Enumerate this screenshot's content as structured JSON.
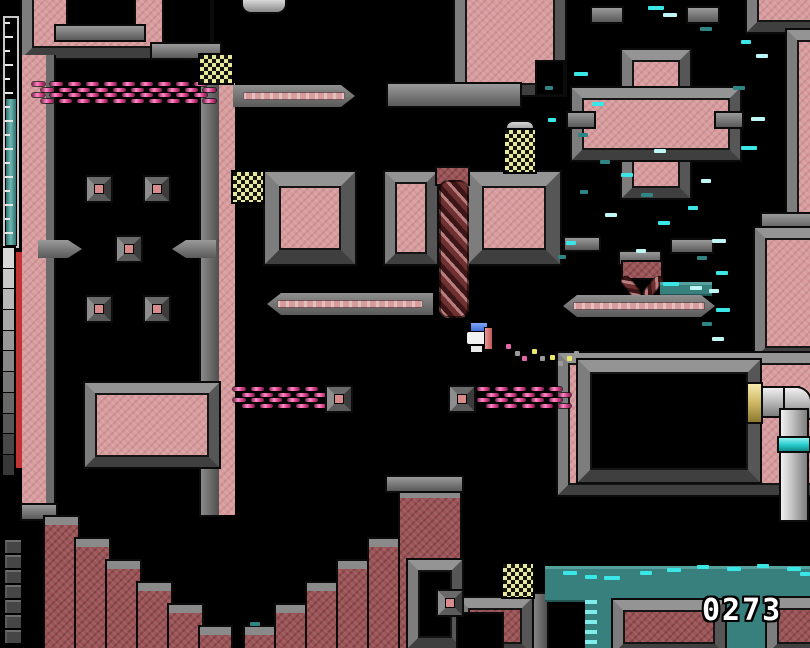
{
  "hud": {
    "score": "0273",
    "energy_gauge": {
      "ticks": 16,
      "fill_pct": 62
    },
    "gray_meter_segments": 11,
    "brick_stack_count": 7
  },
  "palette": {
    "wall_pink": "#d79c9e",
    "wall_maroon": "#9b5356",
    "frame_gray": "#6b6b6b",
    "background": "#000000",
    "drip_cyan_bright": "#3ae6e6",
    "drip_cyan_pale": "#bdf6f4",
    "drip_teal_dim": "#2f8583",
    "water_teal": "#37807e",
    "chain_magenta": "#e0458f",
    "checker_yellow": "#e6e69c",
    "gauge_teal": "#4d9b97",
    "meter_red": "#c23434",
    "pipe_gold": "#d9c56e",
    "player_blue": "#4a7ce0",
    "player_white": "#f2f2f2",
    "player_pink": "#d97c7c"
  },
  "scene": {
    "weaves": [
      {
        "x": 32,
        "y": 82,
        "cols": 10,
        "rows": 4
      },
      {
        "x": 233,
        "y": 387,
        "cols": 5,
        "rows": 4
      },
      {
        "x": 477,
        "y": 387,
        "cols": 5,
        "rows": 4
      }
    ],
    "diamonds": [
      [
        85,
        175
      ],
      [
        143,
        175
      ],
      [
        115,
        235
      ],
      [
        85,
        295
      ],
      [
        143,
        295
      ],
      [
        325,
        385
      ],
      [
        448,
        385
      ],
      [
        436,
        589
      ]
    ],
    "checkers": [
      [
        200,
        55,
        32,
        28
      ],
      [
        233,
        172,
        30,
        30
      ],
      [
        505,
        130,
        30,
        42
      ],
      [
        503,
        564,
        30,
        33
      ]
    ],
    "drips": [
      [
        648,
        6,
        16,
        0
      ],
      [
        663,
        13,
        14,
        1
      ],
      [
        700,
        27,
        12,
        2
      ],
      [
        741,
        40,
        10,
        0
      ],
      [
        756,
        54,
        12,
        1
      ],
      [
        574,
        72,
        14,
        0
      ],
      [
        733,
        86,
        12,
        2
      ],
      [
        592,
        102,
        12,
        0
      ],
      [
        751,
        117,
        14,
        1
      ],
      [
        578,
        133,
        10,
        2
      ],
      [
        741,
        146,
        16,
        0
      ],
      [
        654,
        149,
        12,
        1
      ],
      [
        600,
        160,
        10,
        2
      ],
      [
        621,
        173,
        12,
        0
      ],
      [
        701,
        179,
        10,
        1
      ],
      [
        641,
        193,
        12,
        2
      ],
      [
        688,
        206,
        10,
        0
      ],
      [
        605,
        213,
        12,
        1
      ],
      [
        580,
        190,
        8,
        2
      ],
      [
        658,
        221,
        12,
        0
      ],
      [
        712,
        239,
        14,
        1
      ],
      [
        697,
        256,
        10,
        2
      ],
      [
        716,
        271,
        12,
        0
      ],
      [
        709,
        289,
        10,
        1
      ],
      [
        716,
        308,
        14,
        0
      ],
      [
        702,
        322,
        10,
        2
      ],
      [
        712,
        337,
        12,
        1
      ],
      [
        566,
        241,
        10,
        0
      ],
      [
        558,
        255,
        8,
        2
      ],
      [
        636,
        249,
        10,
        1
      ],
      [
        545,
        86,
        8,
        2
      ],
      [
        548,
        118,
        8,
        0
      ],
      [
        250,
        622,
        10,
        2
      ],
      [
        663,
        282,
        16,
        0
      ],
      [
        690,
        286,
        12,
        1
      ]
    ],
    "sparkles": [
      [
        563,
        571,
        14
      ],
      [
        585,
        575,
        12
      ],
      [
        604,
        576,
        16
      ],
      [
        640,
        571,
        12
      ],
      [
        667,
        568,
        14
      ],
      [
        697,
        565,
        12
      ],
      [
        727,
        567,
        14
      ],
      [
        757,
        564,
        12
      ],
      [
        787,
        567,
        14
      ],
      [
        800,
        572,
        10
      ]
    ],
    "trail_dots": [
      [
        506,
        344,
        "m"
      ],
      [
        515,
        351,
        "g"
      ],
      [
        522,
        356,
        "m"
      ],
      [
        532,
        349,
        "y"
      ],
      [
        540,
        356,
        "g"
      ],
      [
        550,
        355,
        "y"
      ],
      [
        558,
        361,
        "g"
      ],
      [
        567,
        356,
        "y"
      ],
      [
        574,
        351,
        "g"
      ]
    ],
    "trail_colors": {
      "m": "#e465a8",
      "y": "#e8e86a",
      "g": "#9a9a9a"
    }
  }
}
